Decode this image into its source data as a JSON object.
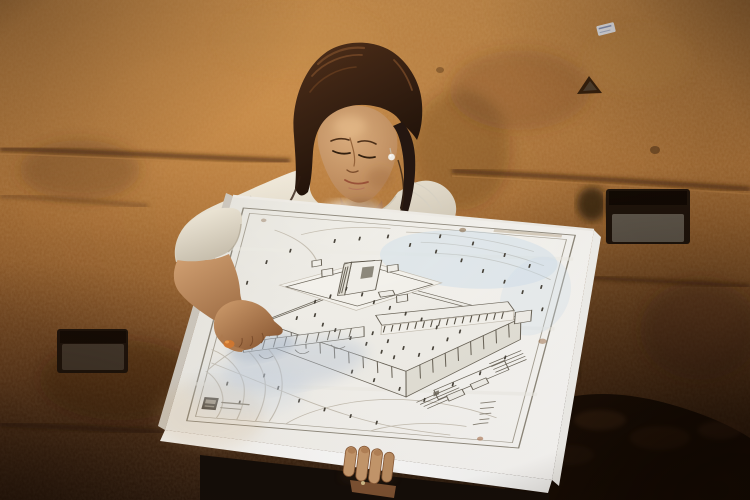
{
  "meta": {
    "kind": "photograph",
    "scene": "Young girl in a white shirt stands before massive ancient stone wall blocks, holding a large white poster board with a pencil reconstruction drawing of the Second Temple complex; her right hand points at the causeway in the drawing, her left hand grips the bottom edge.",
    "canvas": {
      "width": 750,
      "height": 500
    }
  },
  "poster": {
    "content": "aerial line drawing of walled temple platform with colonnaded stoa, central sanctuary, inner court, bridge causeway, southern stairs, terrain contour lines and tiny scattered figures",
    "caption": "small Hebrew print beside a dark logo stamp (illegible at this resolution)",
    "corner_text": "tiny handwritten credit block near bottom-right corner (illegible)"
  },
  "wall_features": {
    "niches": 2,
    "prayer_note": "small folded paper tucked into crack at top right",
    "mortar_joints": "horizontal seams across upper wall, dark rubble at lower right"
  },
  "palette": {
    "wallTop": "#b07a3e",
    "wallMid": "#965f2a",
    "wallLow": "#6a3e1b",
    "wallBottom": "#2e1a0c",
    "glow": "#eca95c",
    "joint": "#3f2310",
    "nicheDark": "#20150c",
    "nicheStone": "#665e52",
    "hair": "#271711",
    "hairHi": "#7e4e2a",
    "skinHi": "#d8a979",
    "skin": "#c89a6e",
    "skinLo": "#8a5a36",
    "shirtHi": "#f3ecdd",
    "shirtLo": "#cfc6b4",
    "board": "#f5f3ee",
    "boardBright": "#fefefe",
    "boardGrey": "#cfc9bf",
    "ink": "#6b6559",
    "inkDark": "#554f43",
    "inkLight": "#c6bfb2",
    "blueWash": "#cfe0ee",
    "shadowBlue": "#b9c6d8",
    "accent": "#d97a2e",
    "pearl": "#f2eee6",
    "dark": "#140d08",
    "caption": "#7d7769",
    "stain": "#9a6a42"
  }
}
